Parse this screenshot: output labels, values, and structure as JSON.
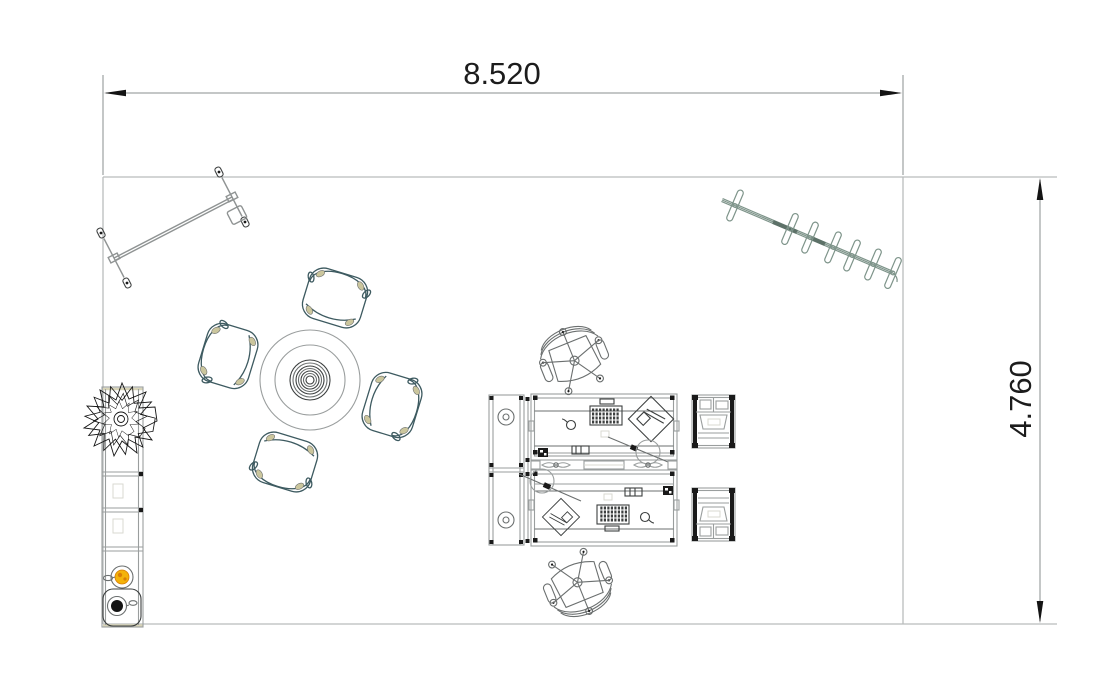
{
  "title": "Office floor plan, top view, with overall dimensions",
  "dimensions": {
    "width": {
      "label": "8.520",
      "value": 8.52
    },
    "height": {
      "label": "4.760",
      "value": 4.76
    }
  },
  "colors": {
    "background": "#ffffff",
    "wall": "#b9bcbc",
    "dim_line": "#8a8f8f",
    "dim_text": "#1c1c1c",
    "arrow": "#141414",
    "furniture_gray": "#9a9e9e",
    "furniture_mid": "#6b6f6f",
    "furniture_dark": "#3c3f3f",
    "chair_teal": "#3d5a60",
    "chair_accent": "#cbc69d",
    "rack_green": "#7e948a",
    "rack_dark": "#5d7168",
    "board_gray": "#8f9393",
    "plant_ink": "#141414",
    "cup_yellow": "#f4b30a",
    "cup_orange": "#d97e07",
    "faint": "#d9d9d2"
  },
  "furniture": [
    {
      "id": "mobile-whiteboard",
      "label": "mobile board on castors"
    },
    {
      "id": "coat-rack",
      "label": "coat rail with hangers",
      "hanger_count": 7
    },
    {
      "id": "meeting-table",
      "label": "round meeting table"
    },
    {
      "id": "tub-chair",
      "label": "tub chair",
      "count": 4
    },
    {
      "id": "shelf-unit",
      "label": "tall shelf unit with plant, bowl and sink"
    },
    {
      "id": "desk-workstation",
      "label": "back-to-back double desk"
    },
    {
      "id": "task-chair",
      "label": "swivel task chair",
      "count": 2
    },
    {
      "id": "pedestal-cabinet",
      "label": "pedestal cabinet",
      "count": 2
    }
  ]
}
